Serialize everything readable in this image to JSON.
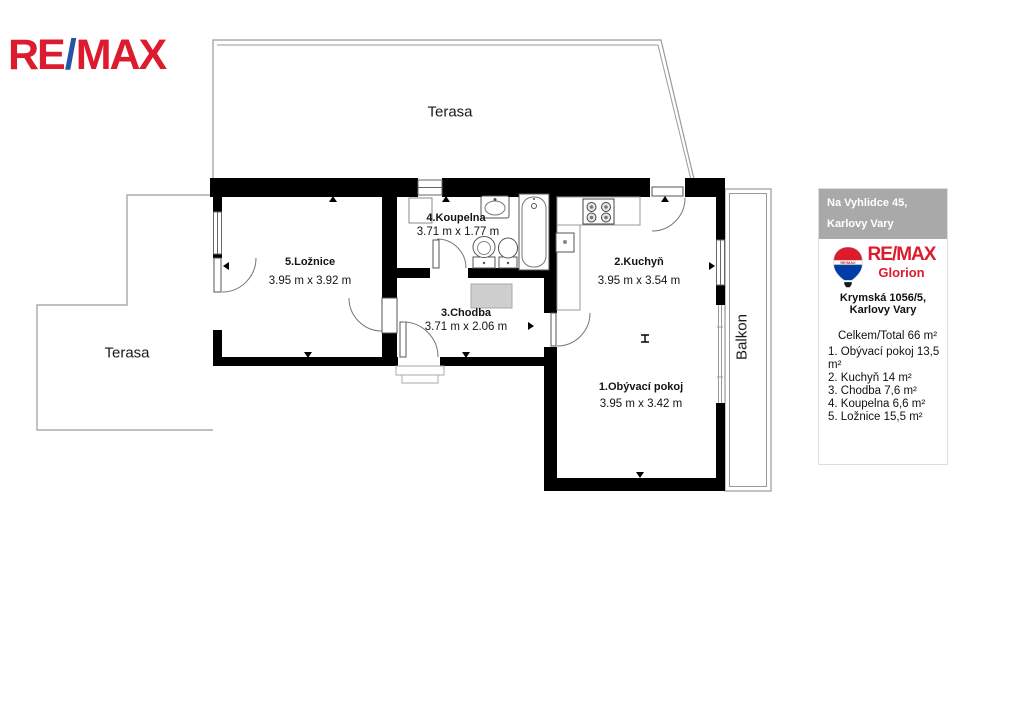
{
  "logo": {
    "re": "RE",
    "slash": "/",
    "max": "MAX"
  },
  "rooms": {
    "terasa_top": {
      "name": "Terasa"
    },
    "terasa_left": {
      "name": "Terasa"
    },
    "balkon": {
      "name": "Balkon"
    },
    "loznice": {
      "name": "5.Ložnice",
      "dims": "3.95 m x 3.92 m"
    },
    "koupelna": {
      "name": "4.Koupelna",
      "dims": "3.71 m x 1.77 m"
    },
    "chodba": {
      "name": "3.Chodba",
      "dims": "3.71 m x 2.06 m"
    },
    "kuchyn": {
      "name": "2.Kuchyň",
      "dims": "3.95 m x 3.54 m"
    },
    "obyvaci": {
      "name": "1.Obývací pokoj",
      "dims": "3.95 m x 3.42 m"
    }
  },
  "panel": {
    "address_line1": "Na Vyhlidce 45,",
    "address_line2": "Karlovy Vary",
    "brand": "RE/MAX",
    "office": "Glorion",
    "office_address": "Krymská 1056/5, Karlovy Vary",
    "total": "Celkem/Total  66  m²",
    "items": [
      "1.  Obývací pokoj 13,5 m²",
      "2.  Kuchyň 14 m²",
      "3.  Chodba 7,6 m²",
      "4.  Koupelna 6,6 m²",
      "5.  Ložnice 15,5 m²"
    ]
  },
  "colors": {
    "remax_red": "#dc1c2e",
    "remax_blue": "#2157a4",
    "balloon_blue": "#003da5",
    "wall_black": "#000000",
    "outline_gray": "#999999",
    "header_gray": "#a9a9a9"
  }
}
